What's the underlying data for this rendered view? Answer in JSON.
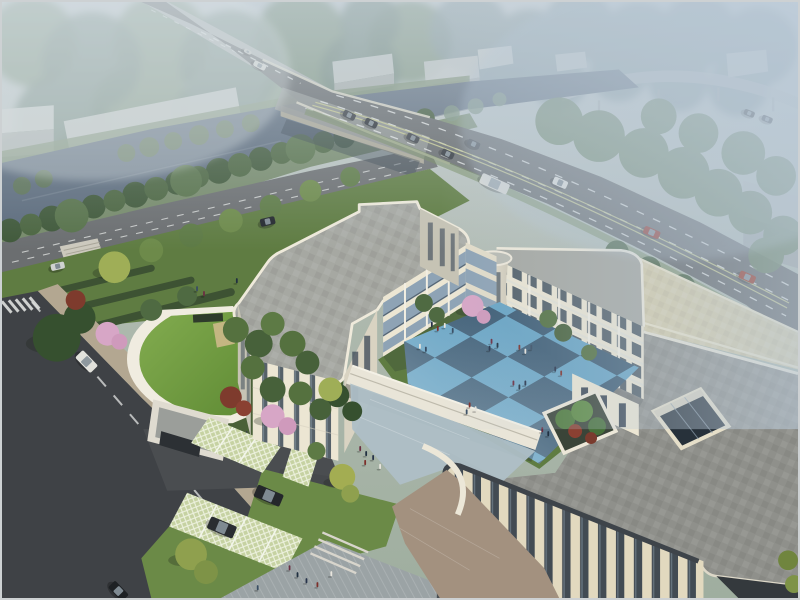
{
  "meta": {
    "kind": "architectural-aerial-rendering",
    "view": "birds-eye perspective at dusk",
    "width": 800,
    "height": 600
  },
  "palette": {
    "sky": "#c7ced3",
    "forest": "#7f957f",
    "water": "#5c6b7c",
    "roadMain": "#626567",
    "roadAvenue": "#6b6e70",
    "roadSite": "#3f4246",
    "bridgeDeck": "#8e918f",
    "laneWhite": "#e6e8e6",
    "laneYellow": "#c9cc8e",
    "sidewalk": "#b3a791",
    "warehouse": "#c3c7c5",
    "lawn": "#5f7c42",
    "lawnBright": "#6b8a47",
    "hedge": "#3d5233",
    "treeDark": "#3f5839",
    "treeMid": "#55713f",
    "treeHazy": "#66805e",
    "treeYellow": "#9fae57",
    "blossomPink": "#d7a6c6",
    "foliageRed": "#7e3b2d",
    "facadeLit": "#ece6d3",
    "facadeWarm": "#e2d9bf",
    "facadeShade": "#c6c3b4",
    "parapet": "#f1ede0",
    "roofGray": "#a6a8a2",
    "roofPavers": "#8f908b",
    "roofTan": "#d7cda9",
    "glassDark": "#3d4956",
    "glassBand": "#8ea3b5",
    "courtLight": "#68a4c4",
    "courtDark": "#3e5d75",
    "greenRoof": "#6f9a3f",
    "lattice": "#cdd6ab",
    "forecourt": "#aebfc6",
    "esplanade": "#9ba3a5",
    "paversWarm": "#a3917f"
  },
  "scene": {
    "river": {
      "label": "canal crossing upper-left, fading into haze at right"
    },
    "bridge": {
      "label": "arterial road bridge over canal"
    },
    "distant_viaduct": {
      "label": "elevated highway in haze, top-right"
    },
    "warehouses": {
      "count": 8
    },
    "building": {
      "label": "three-storey cream campus building",
      "wings": [
        "west-wing",
        "north-wing",
        "east-wing",
        "south-block"
      ],
      "features": [
        "blue-checkerboard-courtyard",
        "curved-corner-tower",
        "single-storey-connecting-corridor",
        "rooftop-atrium-skylight",
        "roof-terrace-planter",
        "front-wing-tall-glazing"
      ]
    },
    "annex": {
      "label": "curved green-roof gatehouse with entry gate"
    },
    "parking": {
      "label": "grass-grid permeable parking stalls",
      "parked_suvs": 2
    },
    "vehicles": [
      {
        "name": "sedan-bridge-1",
        "x": 349,
        "y": 114,
        "len": 13,
        "wid": 7,
        "angle": 26,
        "body": "#30343a"
      },
      {
        "name": "sedan-bridge-2",
        "x": 371,
        "y": 122,
        "len": 13,
        "wid": 7,
        "angle": 26,
        "body": "#22262c"
      },
      {
        "name": "sedan-bridge-3",
        "x": 413,
        "y": 137,
        "len": 13,
        "wid": 7,
        "angle": 25,
        "body": "#383c42"
      },
      {
        "name": "sedan-bridge-4",
        "x": 448,
        "y": 153,
        "len": 13,
        "wid": 7,
        "angle": 25,
        "body": "#2a2e34"
      },
      {
        "name": "sedan-bridge-5",
        "x": 474,
        "y": 143,
        "len": 13,
        "wid": 7,
        "angle": 25,
        "body": "#43474d"
      },
      {
        "name": "bus-main-road",
        "x": 495,
        "y": 183,
        "len": 30,
        "wid": 11,
        "angle": 24,
        "body": "#dcdcd6",
        "glass": "#9aa4aa"
      },
      {
        "name": "car-main-road-white",
        "x": 561,
        "y": 182,
        "len": 15,
        "wid": 8,
        "angle": 24,
        "body": "#e4e4de"
      },
      {
        "name": "red-car-1",
        "x": 653,
        "y": 232,
        "len": 17,
        "wid": 8,
        "angle": 24,
        "body": "#8f2b21"
      },
      {
        "name": "red-car-2",
        "x": 749,
        "y": 277,
        "len": 17,
        "wid": 8,
        "angle": 24,
        "body": "#96301f"
      },
      {
        "name": "car-far-bridge-1",
        "x": 751,
        "y": 112,
        "len": 11,
        "wid": 6,
        "angle": 22,
        "body": "#2c3036"
      },
      {
        "name": "car-far-bridge-2",
        "x": 769,
        "y": 118,
        "len": 11,
        "wid": 6,
        "angle": 22,
        "body": "#3a3e44"
      },
      {
        "name": "bus-distant-road",
        "x": 259,
        "y": 64,
        "len": 13,
        "wid": 6,
        "angle": 28,
        "body": "#d8d8d2"
      },
      {
        "name": "car-distant-road",
        "x": 247,
        "y": 50,
        "len": 8,
        "wid": 4,
        "angle": 28,
        "body": "#c8c8c2"
      },
      {
        "name": "car-avenue-dark",
        "x": 267,
        "y": 221,
        "len": 15,
        "wid": 8,
        "angle": -13,
        "body": "#23272d"
      },
      {
        "name": "car-avenue-parked",
        "x": 56,
        "y": 266,
        "len": 14,
        "wid": 7,
        "angle": -13,
        "body": "#cfd2d0"
      },
      {
        "name": "van-site-road",
        "x": 85,
        "y": 362,
        "len": 22,
        "wid": 11,
        "angle": 46,
        "body": "#e2e2dc",
        "glass": "#8e989e"
      },
      {
        "name": "suv-parked-1",
        "x": 268,
        "y": 497,
        "len": 28,
        "wid": 13,
        "angle": 23,
        "body": "#24272b"
      },
      {
        "name": "suv-parked-2",
        "x": 221,
        "y": 529,
        "len": 28,
        "wid": 13,
        "angle": 23,
        "body": "#2a2d31"
      },
      {
        "name": "car-bottom-left",
        "x": 117,
        "y": 593,
        "len": 20,
        "wid": 10,
        "angle": 46,
        "body": "#1e2124"
      }
    ],
    "people": {
      "clothing_colors": [
        "#27334a",
        "#7d2f2a",
        "#e8e5dd",
        "#394d63",
        "#6b2f42",
        "#203040"
      ],
      "positions": [
        [
          432,
          327
        ],
        [
          438,
          331
        ],
        [
          445,
          328
        ],
        [
          453,
          333
        ],
        [
          492,
          344
        ],
        [
          498,
          348
        ],
        [
          490,
          351
        ],
        [
          520,
          350
        ],
        [
          526,
          354
        ],
        [
          532,
          350
        ],
        [
          514,
          386
        ],
        [
          520,
          390
        ],
        [
          526,
          386
        ],
        [
          470,
          408
        ],
        [
          476,
          412
        ],
        [
          467,
          415
        ],
        [
          543,
          433
        ],
        [
          549,
          437
        ],
        [
          556,
          372
        ],
        [
          562,
          376
        ],
        [
          420,
          349
        ],
        [
          426,
          352
        ],
        [
          360,
          452
        ],
        [
          366,
          457
        ],
        [
          373,
          461
        ],
        [
          365,
          466
        ],
        [
          380,
          470
        ],
        [
          257,
          592
        ],
        [
          289,
          572
        ],
        [
          297,
          579
        ],
        [
          306,
          585
        ],
        [
          317,
          589
        ],
        [
          331,
          578
        ],
        [
          196,
          291
        ],
        [
          203,
          296
        ],
        [
          236,
          283
        ]
      ]
    }
  }
}
